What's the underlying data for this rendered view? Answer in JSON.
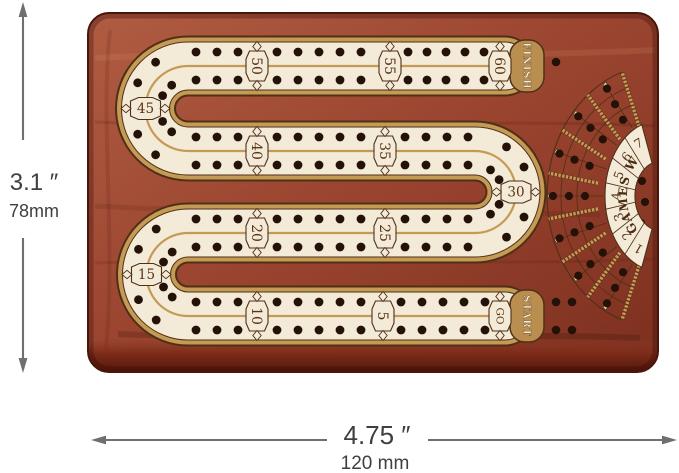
{
  "board": {
    "track_badges": [
      "GO",
      "5",
      "10",
      "15",
      "20",
      "25",
      "30",
      "35",
      "40",
      "45",
      "50",
      "55",
      "60"
    ],
    "start_label": "START",
    "finish_label": "FINISH",
    "fan": {
      "title": "GAMES WON",
      "numbers": [
        "1",
        "2",
        "3",
        "4",
        "5",
        "6",
        "7"
      ]
    },
    "colors": {
      "wood": "#9c4631",
      "wood_dark": "#6b2415",
      "track": "#f3ead8",
      "gold": "#c49a55",
      "outline": "#4f3016",
      "hole": "#241208",
      "badge_text": "#5a3517"
    }
  },
  "dimensions": {
    "height_inches": "3.1 ″",
    "height_mm": "78mm",
    "width_inches": "4.75 ″",
    "width_mm": "120 mm"
  }
}
